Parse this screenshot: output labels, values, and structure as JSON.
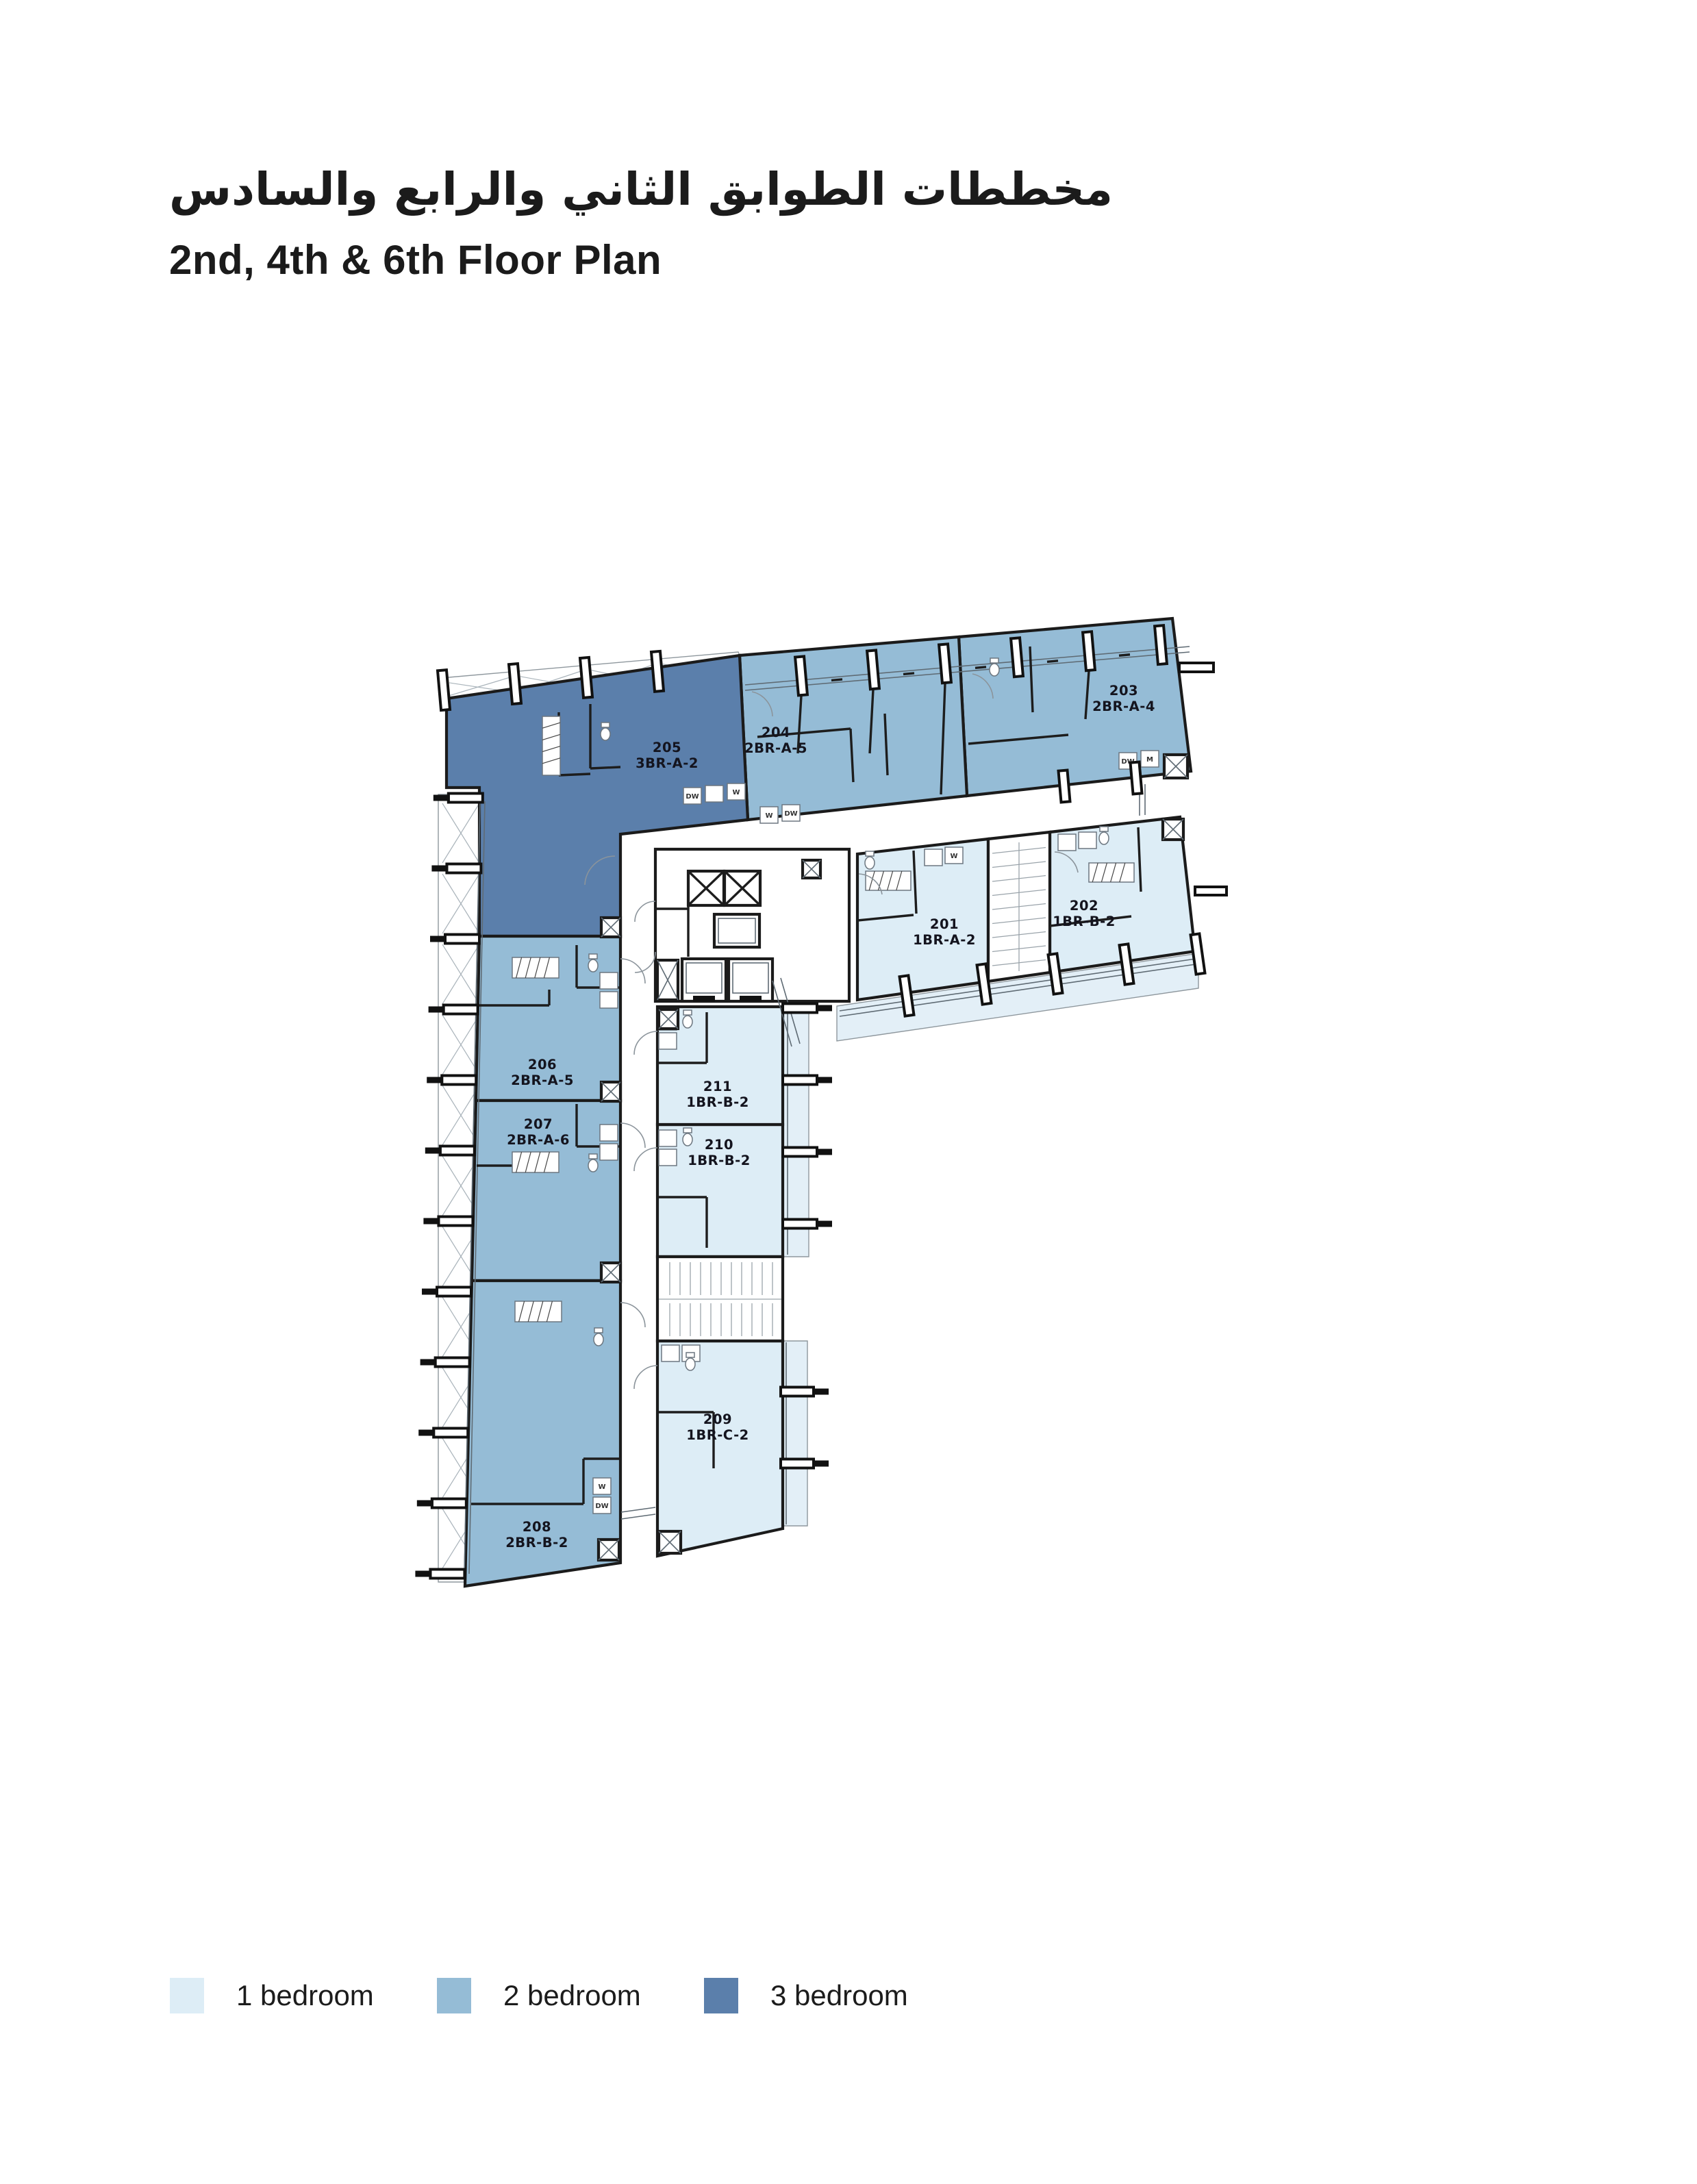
{
  "page": {
    "title_ar": "مخططات الطوابق الثاني والرابع والسادس",
    "title_en": "2nd, 4th & 6th Floor Plan"
  },
  "legend": {
    "items": [
      {
        "label": "1 bedroom",
        "color": "#ddedf6"
      },
      {
        "label": "2 bedroom",
        "color": "#95bcd6"
      },
      {
        "label": "3 bedroom",
        "color": "#5b7fab"
      }
    ]
  },
  "units": [
    {
      "number": "201",
      "type": "1BR-A-2",
      "bedrooms": 1
    },
    {
      "number": "202",
      "type": "1BR-B-2",
      "bedrooms": 1
    },
    {
      "number": "203",
      "type": "2BR-A-4",
      "bedrooms": 2
    },
    {
      "number": "204",
      "type": "2BR-A-5",
      "bedrooms": 2
    },
    {
      "number": "205",
      "type": "3BR-A-2",
      "bedrooms": 3
    },
    {
      "number": "206",
      "type": "2BR-A-5",
      "bedrooms": 2
    },
    {
      "number": "207",
      "type": "2BR-A-6",
      "bedrooms": 2
    },
    {
      "number": "208",
      "type": "2BR-B-2",
      "bedrooms": 2
    },
    {
      "number": "209",
      "type": "1BR-C-2",
      "bedrooms": 1
    },
    {
      "number": "210",
      "type": "1BR-B-2",
      "bedrooms": 1
    },
    {
      "number": "211",
      "type": "1BR-B-2",
      "bedrooms": 1
    }
  ],
  "plan_annotations": {
    "appliance_labels": [
      "DW",
      "W",
      "M"
    ]
  }
}
